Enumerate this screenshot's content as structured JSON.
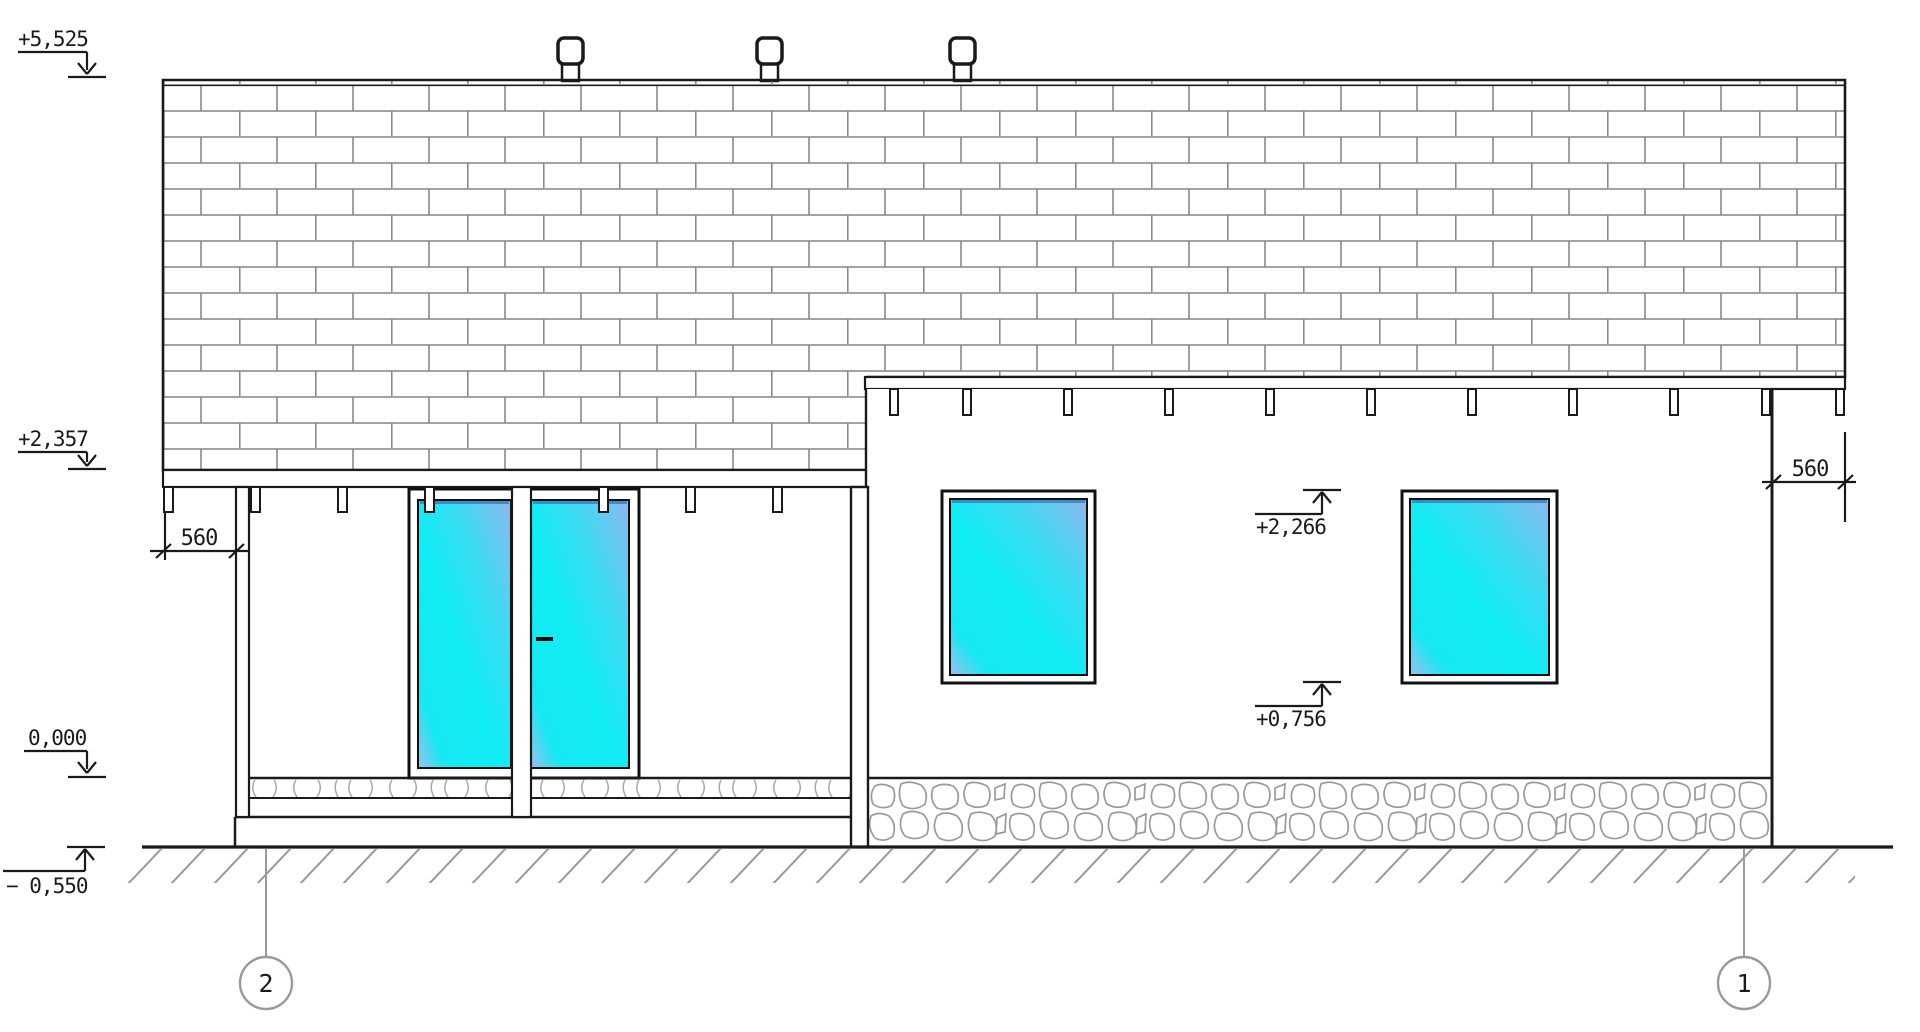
{
  "elevation_labels": {
    "ridge": "+5,525",
    "eave": "+2,357",
    "floor_zero": "0,000",
    "ground": "− 0,550",
    "window_head": "+2,266",
    "window_sill": "+0,756"
  },
  "dimension_labels": {
    "left_overhang": "560",
    "right_overhang": "560"
  },
  "grid_bubbles": {
    "left": "2",
    "right": "1"
  },
  "colors": {
    "background": "#ffffff",
    "line_black": "#1a1a1a",
    "glass_cyan": "#10edf5",
    "glass_blue": "#8fb7ee",
    "masonry_joint_gray": "#848484",
    "stone_gray": "#9a9a9a",
    "annotation_gray": "#9a9a9a"
  }
}
